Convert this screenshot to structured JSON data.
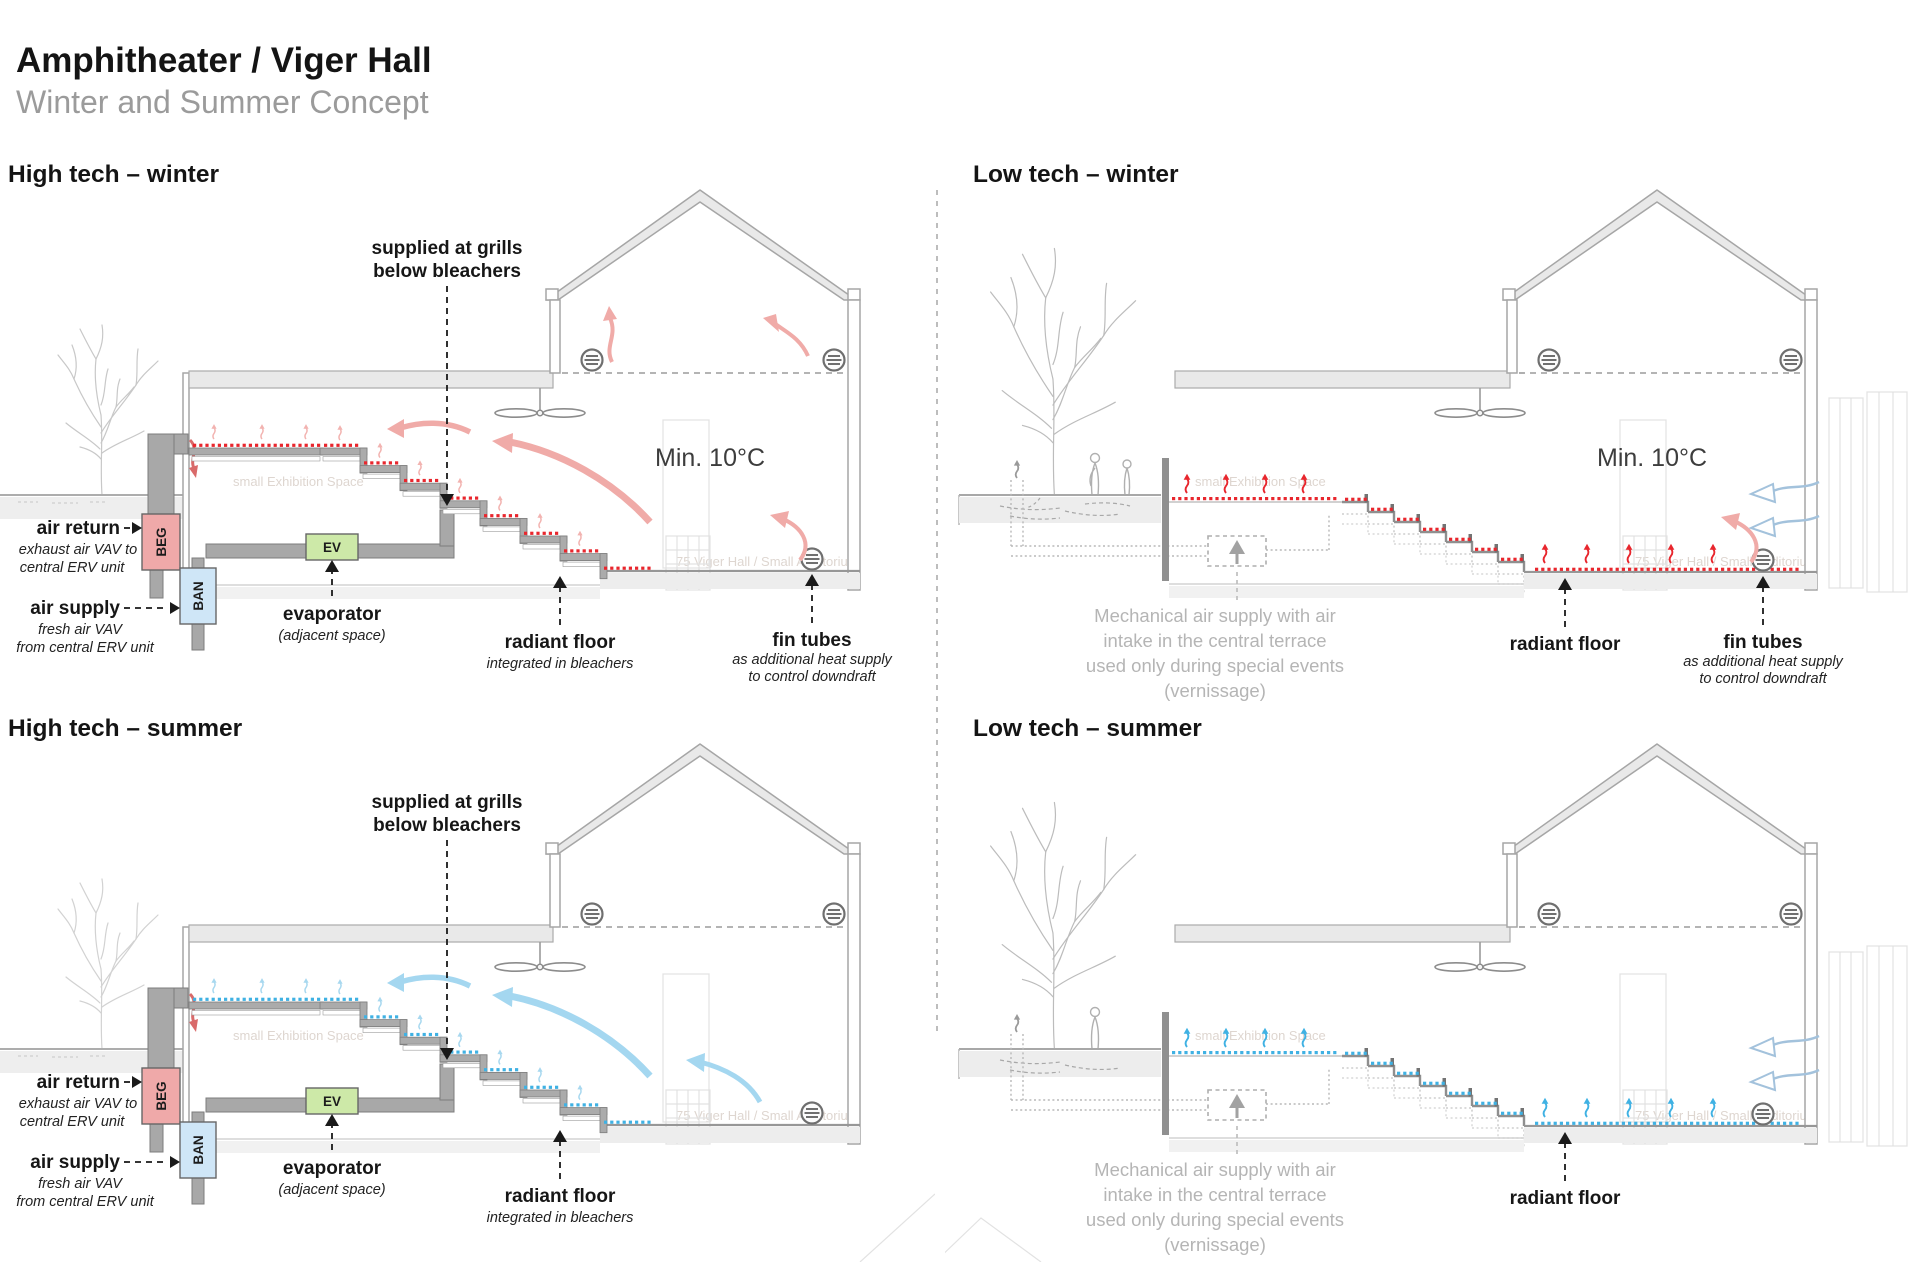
{
  "page": {
    "title": "Amphitheater / Viger Hall",
    "subtitle": "Winter and Summer Concept"
  },
  "colors": {
    "heat_red": "#e8262d",
    "cool_blue": "#3fb1e3",
    "warm_air_arrow": "#f0aba8",
    "cool_air_arrow": "#a4d7f0",
    "duct_gray": "#a8a8a8",
    "beg_box": "#efa9a9",
    "ban_box": "#cfe6f7",
    "ev_box": "#cde9a8",
    "note_gray": "#b5b5b5"
  },
  "background_texts": {
    "exhibition": "small Exhibition Space",
    "auditorium": "75 Viger Hall / Small Auditorium"
  },
  "quadrants": {
    "high_winter": {
      "heading": "High tech – winter",
      "min_temp": "Min. 10°C",
      "labels": {
        "supplied1": "supplied at grills",
        "supplied2": "below bleachers",
        "air_return": "air return",
        "air_return_sub1": "exhaust air VAV to",
        "air_return_sub2": "central ERV unit",
        "air_supply": "air supply",
        "air_supply_sub1": "fresh air VAV",
        "air_supply_sub2": "from central ERV unit",
        "beg": "BEG",
        "ban": "BAN",
        "ev": "EV",
        "evaporator": "evaporator",
        "evaporator_sub": "(adjacent space)",
        "radiant_floor": "radiant floor",
        "radiant_floor_sub": "integrated in bleachers",
        "fin_tubes": "fin tubes",
        "fin_tubes_sub1": "as additional heat supply",
        "fin_tubes_sub2": "to control downdraft"
      }
    },
    "high_summer": {
      "heading": "High tech – summer",
      "labels": {
        "supplied1": "supplied at grills",
        "supplied2": "below bleachers",
        "air_return": "air return",
        "air_return_sub1": "exhaust air VAV to",
        "air_return_sub2": "central ERV unit",
        "air_supply": "air supply",
        "air_supply_sub1": "fresh air VAV",
        "air_supply_sub2": "from central ERV unit",
        "beg": "BEG",
        "ban": "BAN",
        "ev": "EV",
        "evaporator": "evaporator",
        "evaporator_sub": "(adjacent space)",
        "radiant_floor": "radiant floor",
        "radiant_floor_sub": "integrated in bleachers"
      }
    },
    "low_winter": {
      "heading": "Low tech – winter",
      "min_temp": "Min. 10°C",
      "labels": {
        "radiant_floor": "radiant floor",
        "fin_tubes": "fin tubes",
        "fin_tubes_sub1": "as additional heat supply",
        "fin_tubes_sub2": "to control downdraft"
      },
      "mech_note": [
        "Mechanical air supply with air",
        "intake in the central terrace",
        "used only during special events",
        "(vernissage)"
      ]
    },
    "low_summer": {
      "heading": "Low tech – summer",
      "labels": {
        "radiant_floor": "radiant floor"
      },
      "mech_note": [
        "Mechanical air supply with air",
        "intake in the central terrace",
        "used only during special events",
        "(vernissage)"
      ]
    }
  }
}
